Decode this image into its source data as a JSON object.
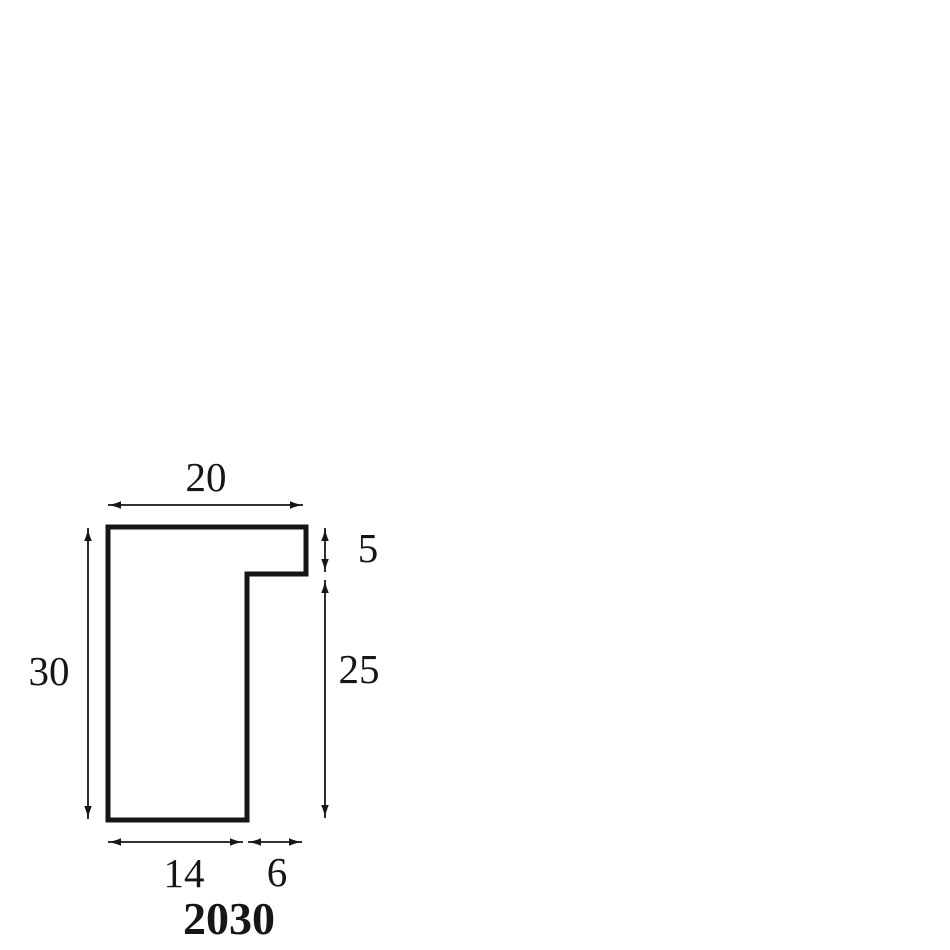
{
  "diagram": {
    "kind": "moulding-profile-cross-section",
    "title": "2030",
    "labels": {
      "top_width": "20",
      "left_height": "30",
      "upper_right_height": "5",
      "lower_right_height": "25",
      "bottom_left_width": "14",
      "bottom_right_width": "6"
    },
    "colors": {
      "line": "#161616",
      "background": "#ffffff"
    }
  }
}
